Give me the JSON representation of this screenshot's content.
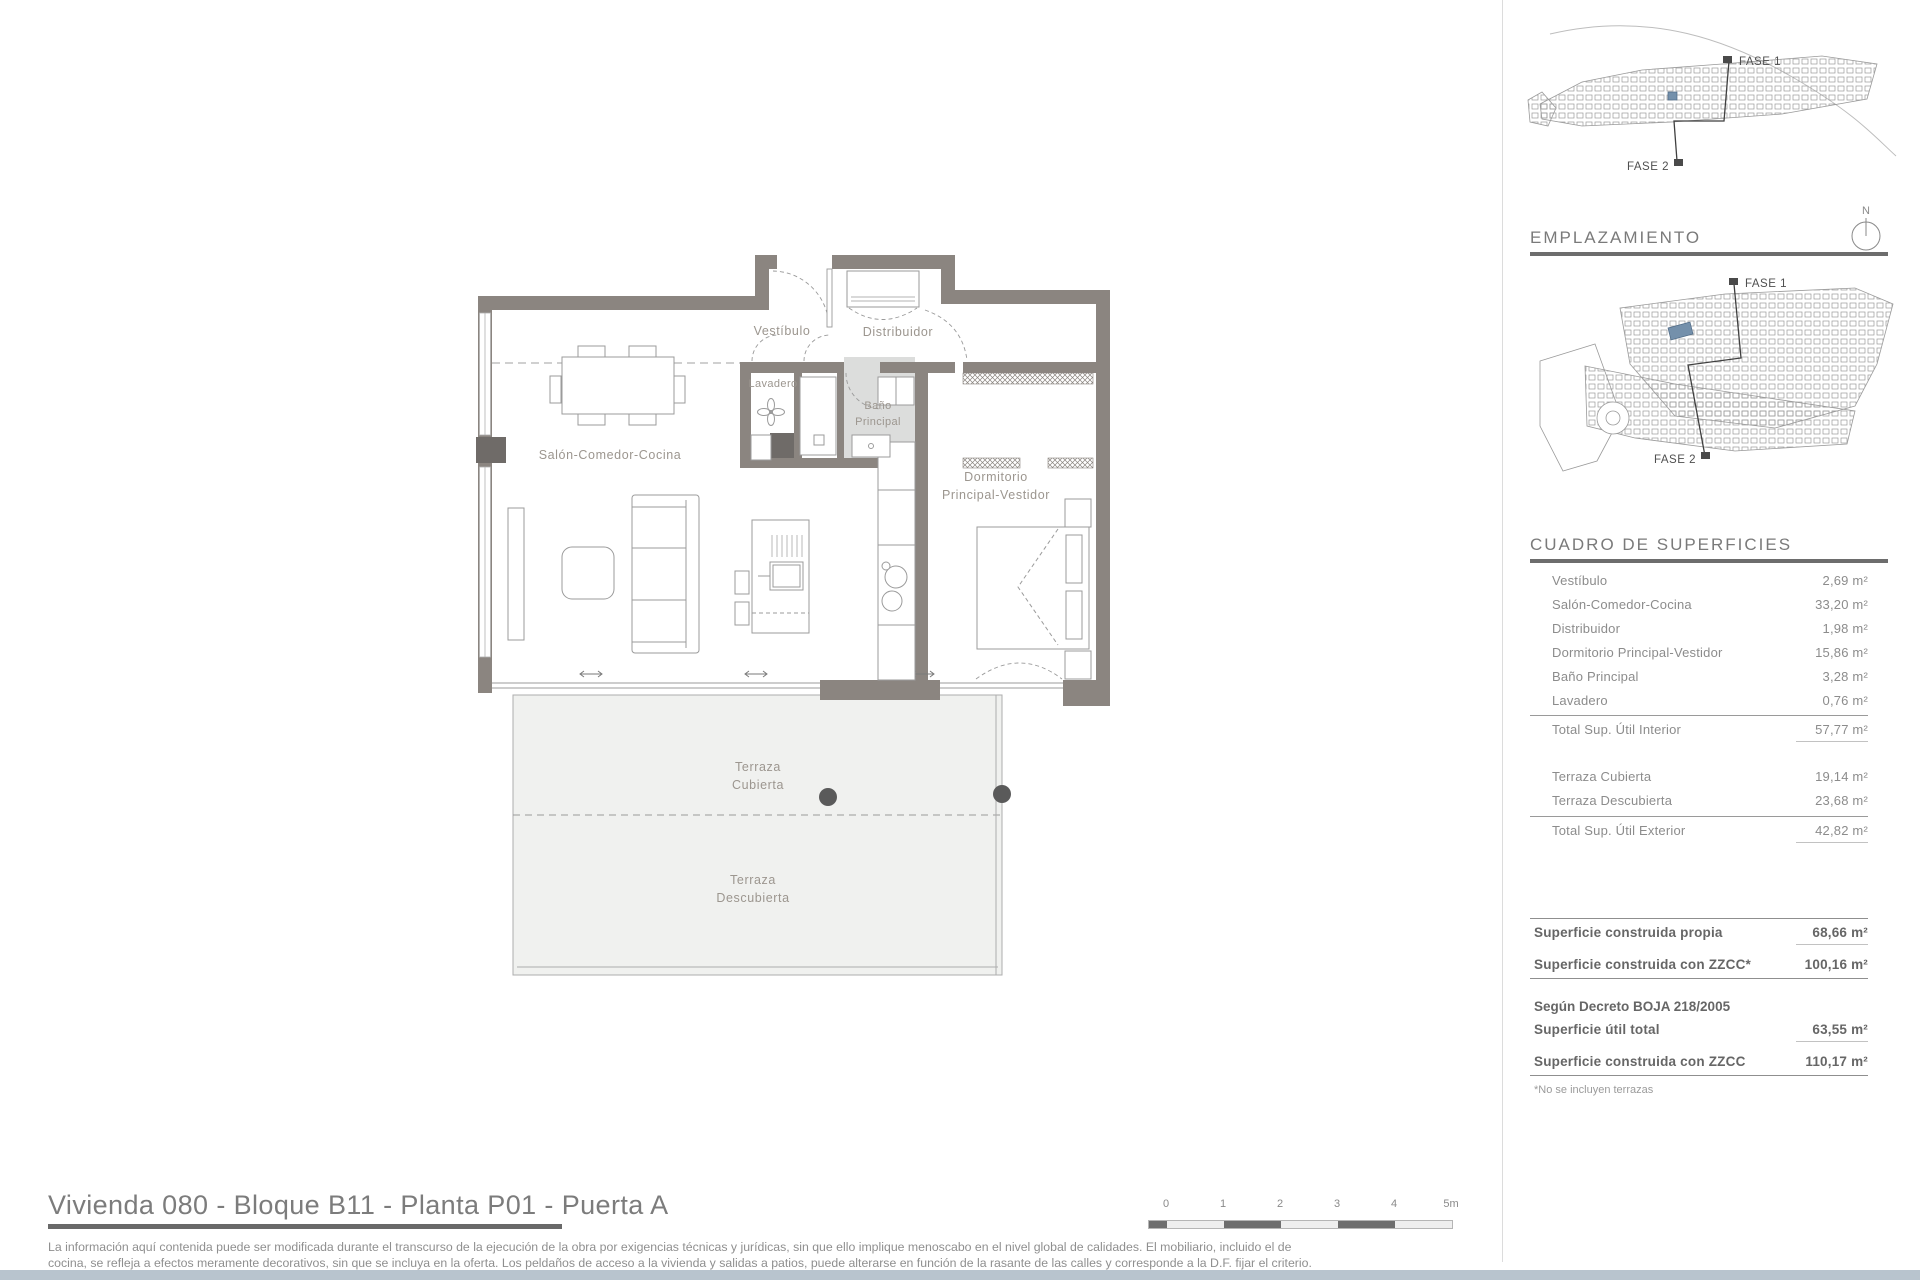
{
  "page": {
    "title": "Vivienda 080 - Bloque B11 - Planta P01 - Puerta A",
    "disclaimer_line1": "La información aquí contenida puede ser modificada durante el transcurso de la ejecución de la obra por exigencias técnicas y jurídicas, sin que ello implique menoscabo en el nivel global de calidades. El mobiliario, incluido el de",
    "disclaimer_line2": "cocina, se refleja a efectos meramente decorativos, sin que se incluya en la oferta. Los peldaños de acceso a la vivienda y salidas a patios, puede alterarse en función de la rasante de las calles y corresponde a la D.F. fijar el criterio."
  },
  "floorplan": {
    "labels": {
      "vestibulo": "Vestíbulo",
      "distribuidor": "Distribuidor",
      "lavadero": "Lavadero",
      "bano_1": "Baño",
      "bano_2": "Principal",
      "salon": "Salón-Comedor-Cocina",
      "dormitorio_1": "Dormitorio",
      "dormitorio_2": "Principal-Vestidor",
      "terraza_cubierta_1": "Terraza",
      "terraza_cubierta_2": "Cubierta",
      "terraza_descubierta_1": "Terraza",
      "terraza_descubierta_2": "Descubierta"
    }
  },
  "scalebar": {
    "labels": [
      "0",
      "1",
      "2",
      "3",
      "4",
      "5m"
    ]
  },
  "sidebar": {
    "sitemap_top": {
      "fase1": "FASE 1",
      "fase2": "FASE 2"
    },
    "emplazamiento": {
      "title": "EMPLAZAMIENTO",
      "compass_label": "N",
      "fase1": "FASE 1",
      "fase2": "FASE 2"
    },
    "superficies": {
      "title": "CUADRO DE SUPERFICIES",
      "interior_rows": [
        {
          "label": "Vestíbulo",
          "value": "2,69 m²"
        },
        {
          "label": "Salón-Comedor-Cocina",
          "value": "33,20 m²"
        },
        {
          "label": "Distribuidor",
          "value": "1,98 m²"
        },
        {
          "label": "Dormitorio Principal-Vestidor",
          "value": "15,86 m²"
        },
        {
          "label": "Baño Principal",
          "value": "3,28 m²"
        },
        {
          "label": "Lavadero",
          "value": "0,76 m²"
        }
      ],
      "interior_total": {
        "label": "Total Sup. Útil Interior",
        "value": "57,77 m²"
      },
      "exterior_rows": [
        {
          "label": "Terraza Cubierta",
          "value": "19,14 m²"
        },
        {
          "label": "Terraza Descubierta",
          "value": "23,68 m²"
        }
      ],
      "exterior_total": {
        "label": "Total Sup. Útil Exterior",
        "value": "42,82 m²"
      },
      "construida_rows": [
        {
          "label": "Superficie construida propia",
          "value": "68,66 m²"
        },
        {
          "label": "Superficie construida con ZZCC*",
          "value": "100,16 m²"
        }
      ],
      "decreto_heading": "Según Decreto BOJA 218/2005",
      "decreto_rows": [
        {
          "label": "Superficie útil total",
          "value": "63,55 m²"
        },
        {
          "label": "Superficie construida con ZZCC",
          "value": "110,17 m²"
        }
      ],
      "footnote": "*No se incluyen terrazas"
    }
  },
  "colors": {
    "wall": "#8b8580",
    "wall_dark": "#6f6b68",
    "bath_fill": "#dcdddc",
    "terrace_fill": "#f0f1ef",
    "accent_blue": "#7490ab",
    "footer_strip": "#b8c4ce",
    "heading_grey": "#7a7a7a",
    "text_grey": "#8c8c8c"
  }
}
